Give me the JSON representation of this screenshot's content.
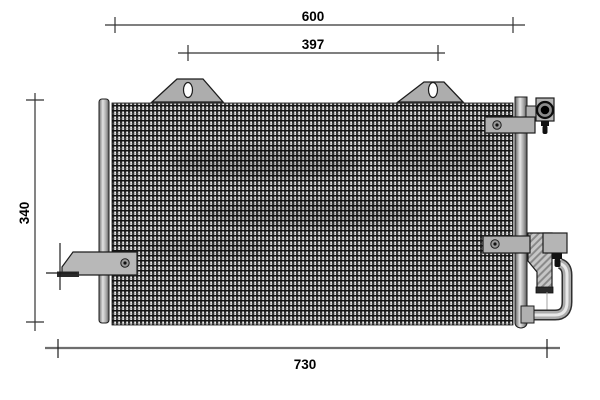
{
  "drawing": {
    "kind": "technical-dimension-drawing",
    "subject": "condenser-front-view",
    "dimensions": {
      "core_width": "600",
      "mount_hole_spacing": "397",
      "core_height": "340",
      "overall_width": "730"
    },
    "colors": {
      "outline": "#1d1d1d",
      "dim_line": "#333333",
      "overall_dim_line": "#6e6e6e",
      "bracket_fill": "#b0b0b0",
      "core_dark": "#2b2b2b",
      "core_light": "#ededed",
      "port_black": "#000000"
    }
  }
}
